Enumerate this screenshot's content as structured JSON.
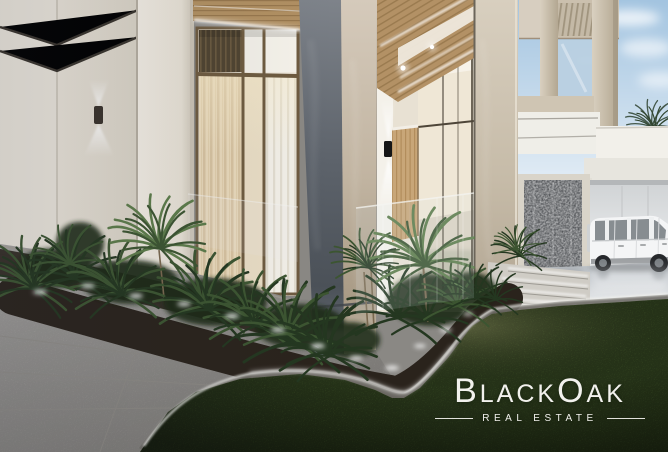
{
  "scene": {
    "description": "Modern luxury villa exterior rendering at dusk: marble-clad entrance columns, glass entry with wooden door, tropical planter beds with uplighting, gray tile walkway, lawn, water-feature wall, and a white SUV parked in an open garage under a blue sky"
  },
  "logo": {
    "brand_initial_1": "B",
    "brand_part_1": "LACK",
    "brand_initial_2": "O",
    "brand_part_2": "AK",
    "full_name": "BlackOak",
    "tagline": "REAL ESTATE"
  },
  "colors": {
    "sky-top": "#a3c4e0",
    "wall-cream": "#e9e4da",
    "marble-dark": "#5d636b",
    "marble-beige": "#c1b4a1",
    "door-wood": "#c8a678",
    "foliage-dark": "#243720",
    "foliage-mid": "#3c5531",
    "foliage-lite": "#5d7c4a",
    "soil": "#2a231c",
    "grass": "#4b6530",
    "pavement": "#aeaba6",
    "driveway": "#dfe2e5",
    "water-wall": "#34373b",
    "car-body": "#f4f5f6",
    "led-glow": "#ffffff",
    "logo-text": "#f2f1ed"
  }
}
